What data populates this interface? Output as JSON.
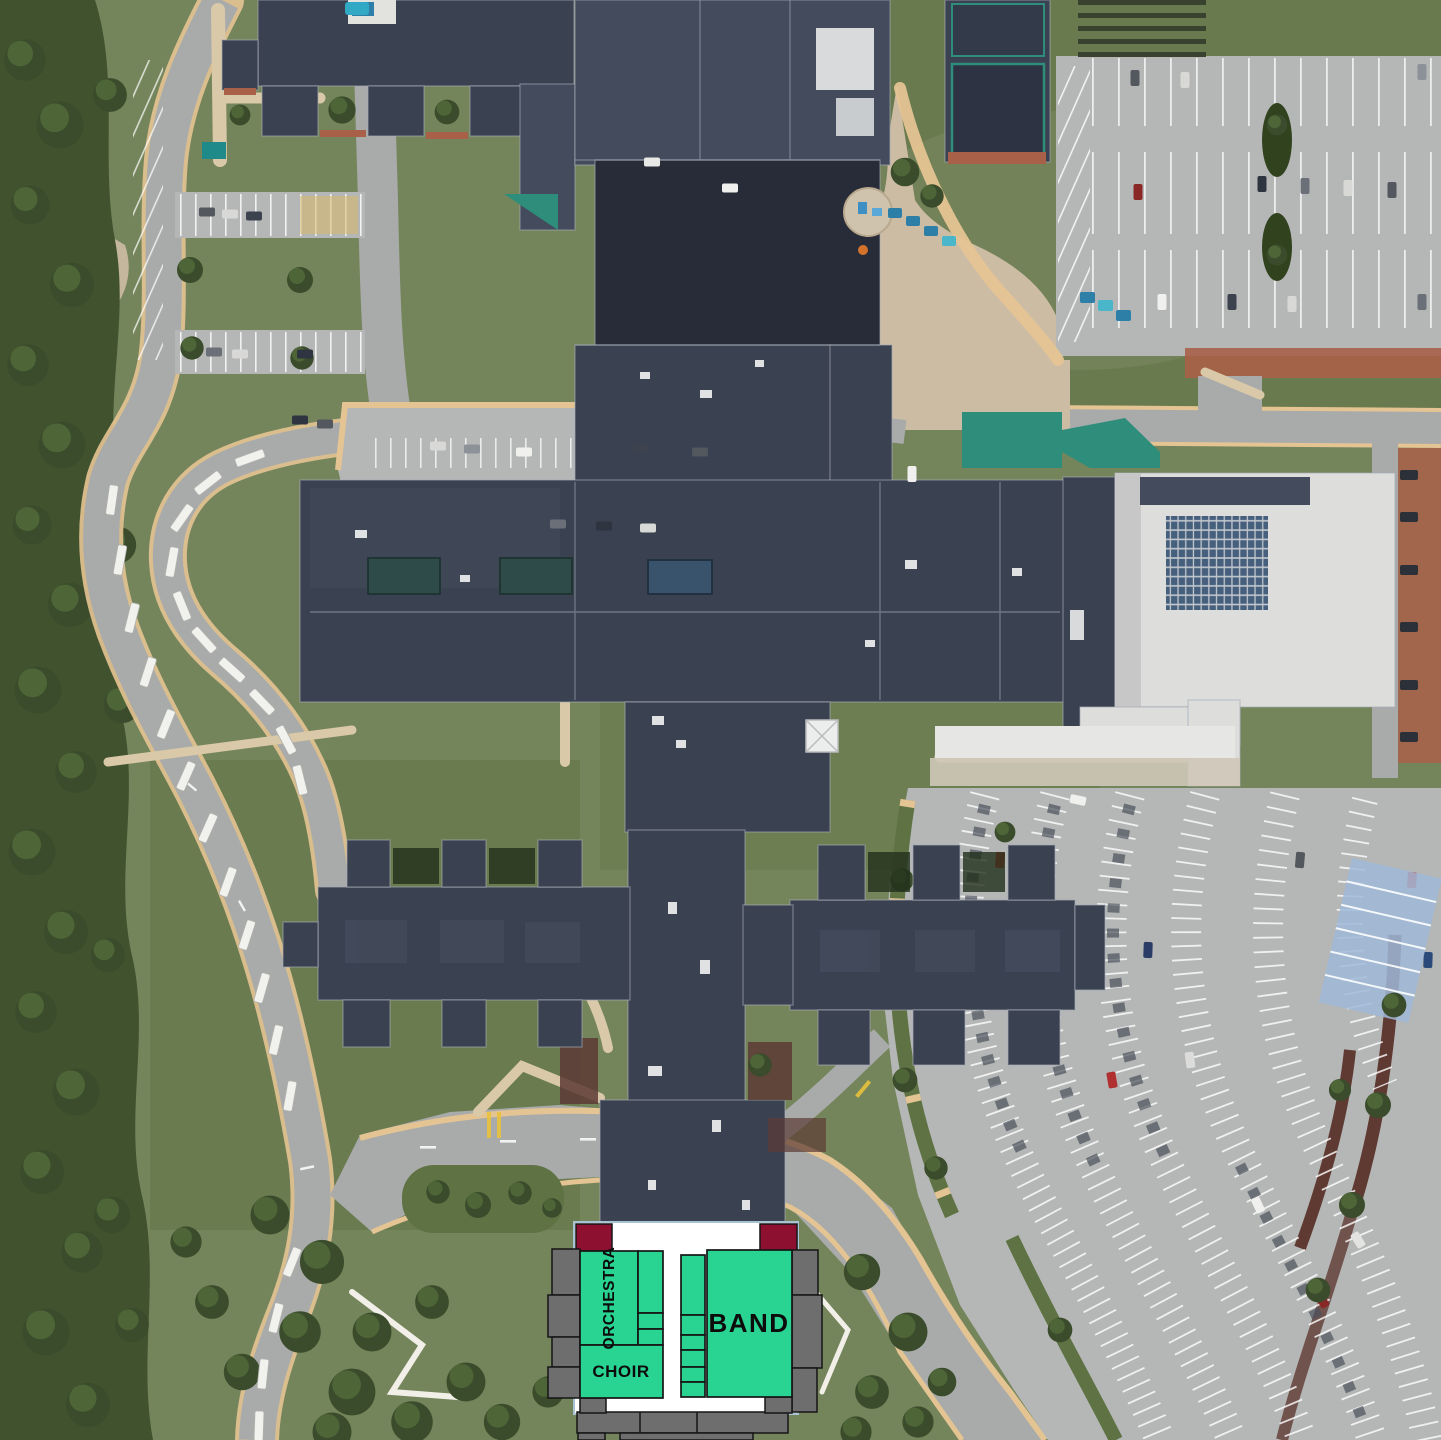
{
  "overlay": {
    "rooms": [
      {
        "id": "orchestra",
        "label": "ORCHESTRA"
      },
      {
        "id": "choir",
        "label": "CHOIR"
      },
      {
        "id": "band",
        "label": "BAND"
      }
    ],
    "colors": {
      "highlight_green": "#29D492",
      "structure_gray": "#6E6E6E",
      "stage_maroon": "#8E1030",
      "plan_white": "#FFFFFF",
      "outline_black": "#151515",
      "frame_blue": "#A9C3D4"
    }
  },
  "map": {
    "description": "aerial satellite view of school campus",
    "colors": {
      "grass": "#75855B",
      "lawn_dark": "#5E7243",
      "forest": "#41522F",
      "road": "#A9ABAA",
      "parking": "#B5B7B6",
      "curb_tan": "#E5C493",
      "roof_dark": "#3A4150",
      "roof_mid": "#434B5C",
      "roof_darker": "#272C38",
      "roof_white": "#DDDEDC",
      "canopy_teal": "#2E8E7B",
      "solar_blue": "#455F7D",
      "brick": "#A96049",
      "concrete_tan": "#CDBCA4"
    }
  }
}
